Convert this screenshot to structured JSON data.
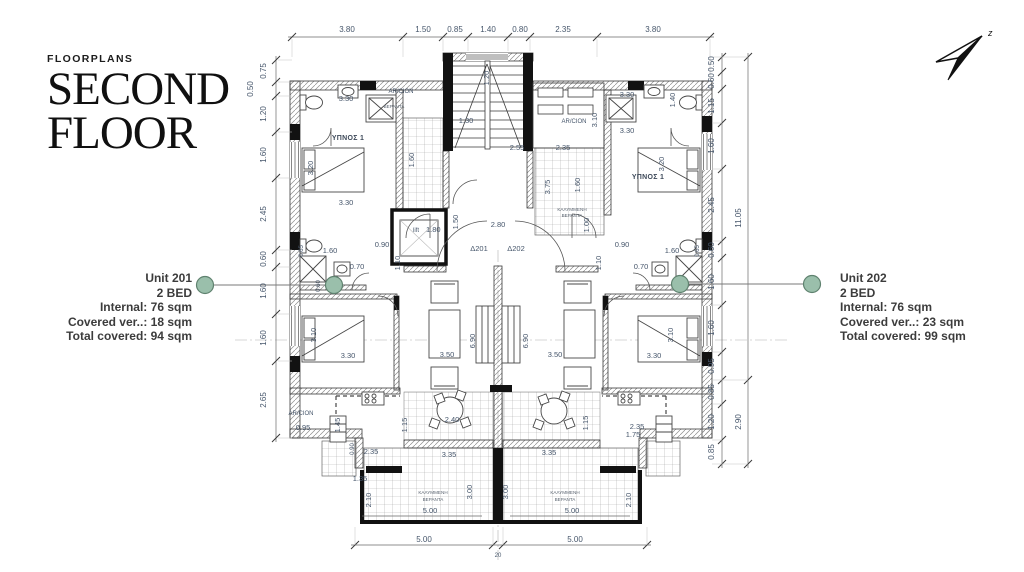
{
  "title": {
    "eyebrow": "FLOORPLANS",
    "line1": "SECOND",
    "line2": "FLOOR"
  },
  "annotations": {
    "unit201": {
      "name": "Unit 201",
      "beds": "2 BED",
      "internal": "Internal: 76 sqm",
      "veranda": "Covered ver..: 18 sqm",
      "total": "Total covered: 94 sqm"
    },
    "unit202": {
      "name": "Unit 202",
      "beds": "2 BED",
      "internal": "Internal: 76 sqm",
      "veranda": "Covered ver..: 23 sqm",
      "total": "Total covered: 99 sqm"
    }
  },
  "colors": {
    "marker_fill": "#9abfab",
    "marker_stroke": "#5f826f",
    "dim_text": "#46566b"
  },
  "north": {
    "label": "z"
  },
  "plan": {
    "top_dims": [
      "3.80",
      "1.50",
      "0.85",
      "1.40",
      "0.80",
      "2.35",
      "3.80"
    ],
    "left_dims": [
      "0.75",
      "0.50",
      "1.20",
      "1.60",
      "2.45",
      "0.60",
      "1.60",
      "1.60",
      "2.65"
    ],
    "right_dims": [
      "0.50",
      "0.60",
      "1.15",
      "1.60",
      "2.45",
      "0.60",
      "1.60",
      "1.60",
      "0.95",
      "0.85",
      "1.20",
      "0.85"
    ],
    "right_outer_dims": [
      "11.05",
      "2.90"
    ],
    "bottom_dims": [
      "5.00",
      "20",
      "5.00"
    ],
    "center": {
      "stair_w": "1.20",
      "stair_run": "1.30",
      "stair_hall": "2.55",
      "entry_w": "2.80",
      "entry_d": "1.50",
      "lift": "lift",
      "lift_w": "1.80",
      "door_201": "Δ201",
      "door_202": "Δ202",
      "strip_d": "1.60",
      "court_w": "2.35",
      "court_h": "3.75",
      "court_w2": "1.60",
      "court_d": "1.00",
      "ac_right": "AR/CION",
      "ac_right_h": "3.10",
      "ac_left": "AR/CION",
      "ac_left_sub": "ΒΕΡΑΝΤΑ",
      "court_label1": "ΚΑΛΥΜΜΕΝΗ",
      "court_label2": "ΒΕΡΑΝΤΑ"
    },
    "unit201": {
      "bedroom": "ΥΠΝΟΣ 1",
      "br1_w": "3.30",
      "br1_w2": "3.30",
      "bed": "3.20",
      "bath_w": "1.60",
      "bath_d": "0.65",
      "shower": "0.70",
      "door": "0.90",
      "hall": "1.10",
      "wc": "0.60",
      "br2_w": "3.30",
      "br2_bed": "3.10",
      "sofa": "3.50",
      "living_l": "6.90",
      "ac": "AR/CION",
      "ac_w": "0.95",
      "kit_d": "1.45",
      "kit_w": "2.35",
      "kit_door": "0.90",
      "din_d": "1.15",
      "din_table": "2.40",
      "din_w": "3.35",
      "ver_step": "1.35",
      "ver_d": "2.10",
      "ver_d2": "3.00",
      "ver_w": "5.00",
      "ver_label1": "ΚΑΛΥΜΜΕΝΗ",
      "ver_label2": "ΒΕΡΑΝΤΑ"
    },
    "unit202": {
      "bedroom": "ΥΠΝΟΣ 1",
      "br1_w": "3.30",
      "br1_w2": "3.30",
      "br1_d": "1.40",
      "bed": "3.20",
      "bath_w": "1.60",
      "bath_d": "0.65",
      "shower": "0.70",
      "door": "0.90",
      "hall": "1.10",
      "br2_w": "3.30",
      "br2_bed": "3.10",
      "sofa": "3.50",
      "living_l": "6.90",
      "din_d": "1.15",
      "kit_w": "2.35",
      "kit_w2": "1.75",
      "din_w": "3.35",
      "ver_d": "2.10",
      "ver_d2": "3.00",
      "ver_w": "5.00",
      "ver_label1": "ΚΑΛΥΜΜΕΝΗ",
      "ver_label2": "ΒΕΡΑΝΤΑ"
    }
  }
}
